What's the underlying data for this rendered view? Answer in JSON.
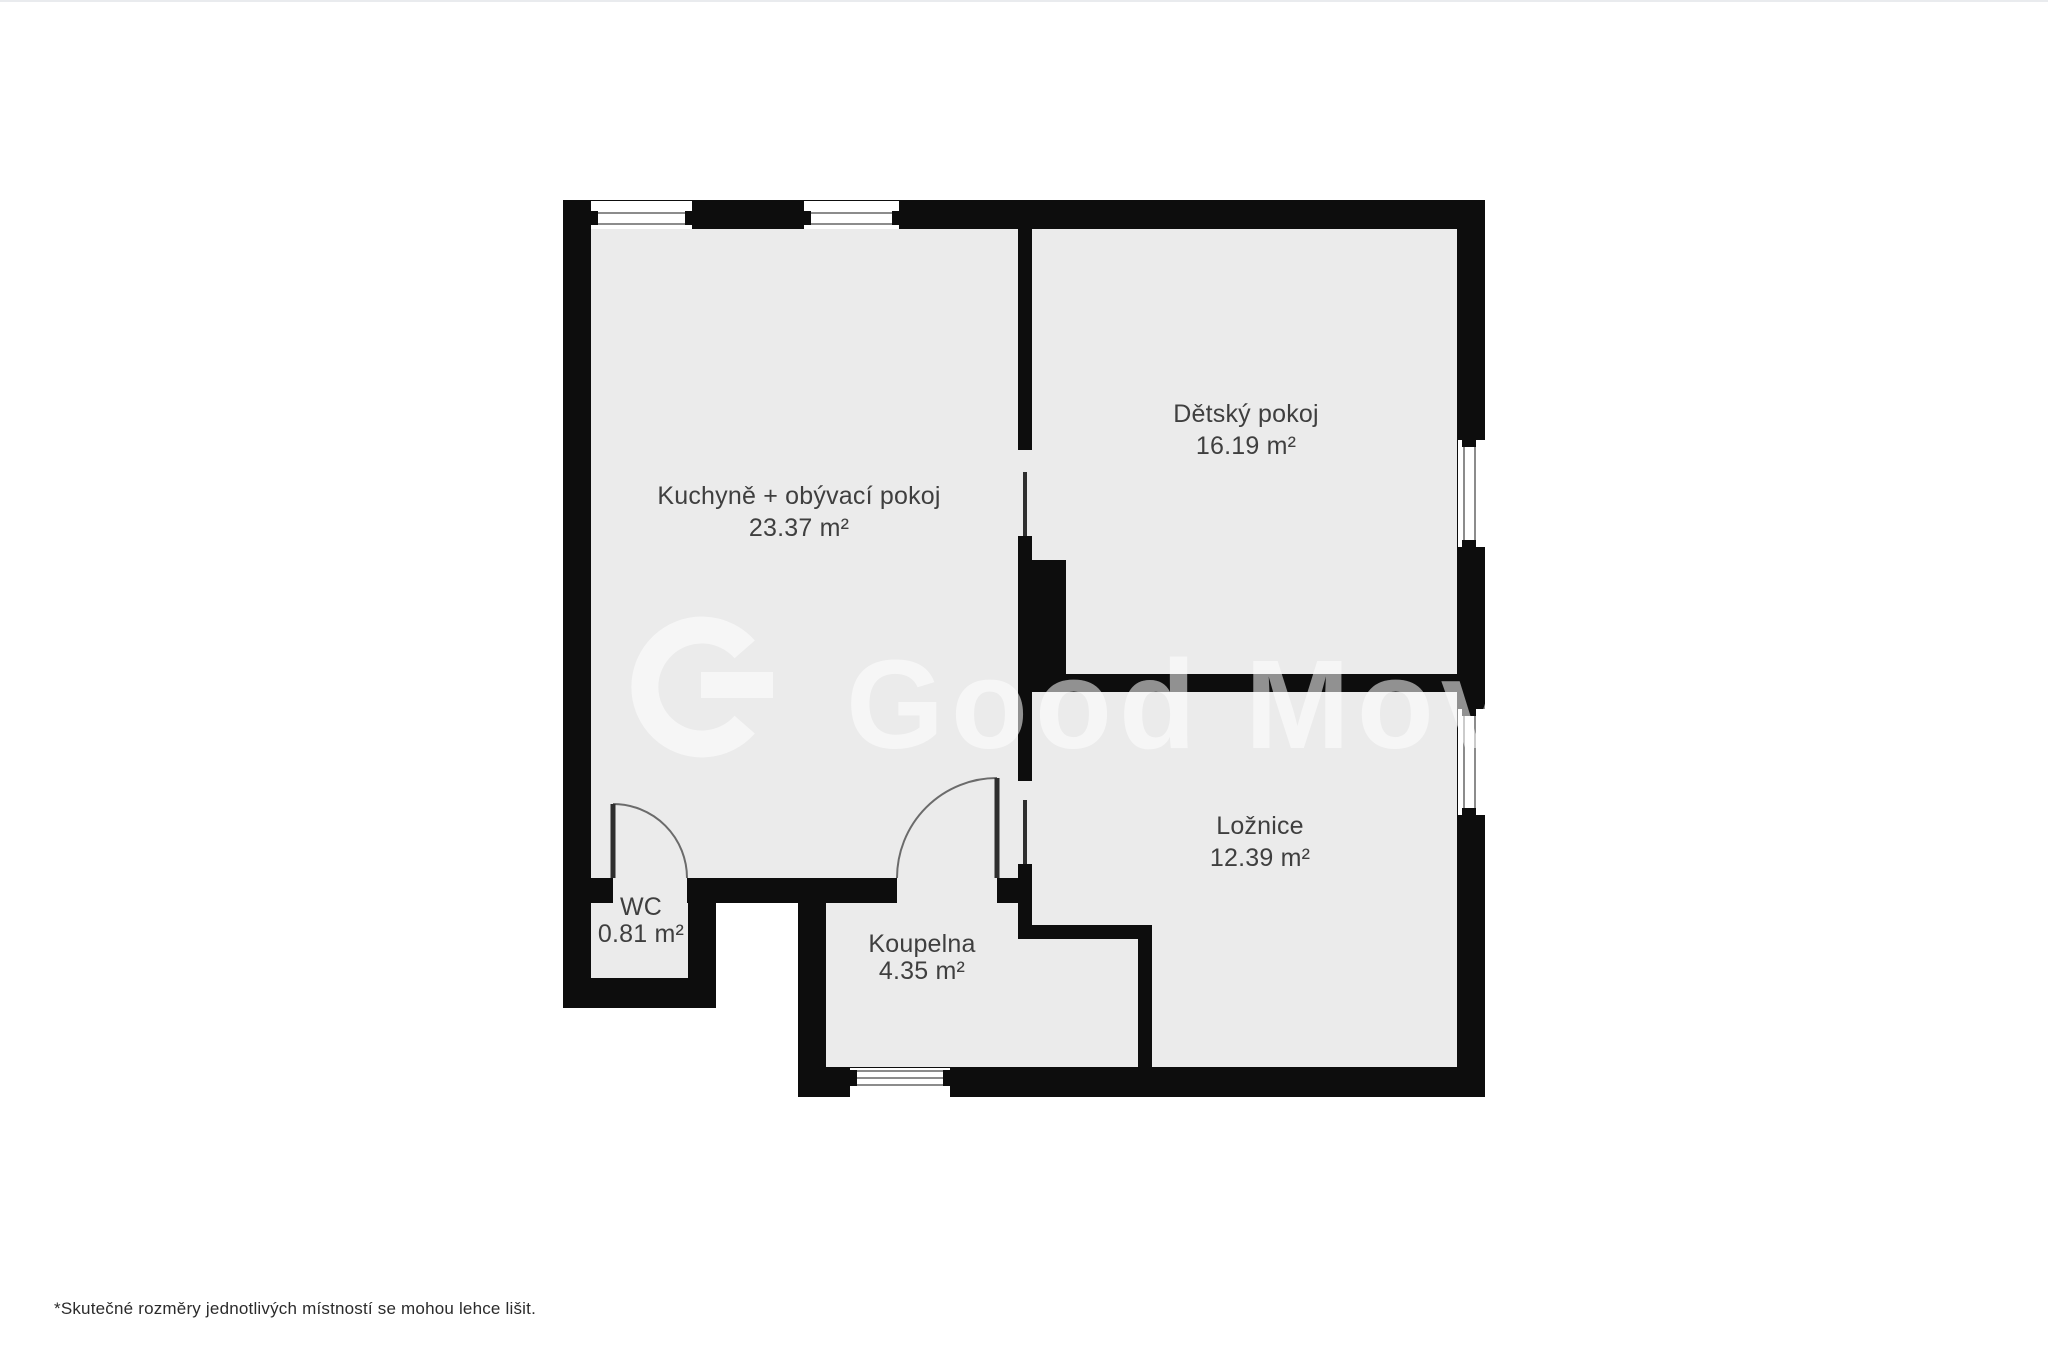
{
  "page": {
    "footnote": "*Skutečné rozměry jednotlivých místností se mohou lehce lišit."
  },
  "palette": {
    "wall": "#0d0d0d",
    "floor": "#ebebeb",
    "window_line": "#8c8c8c",
    "label_text": "#3f3f3f",
    "door_line": "#6b6b6b",
    "background": "#ffffff"
  },
  "watermark": {
    "text": "Good Move",
    "logo": "goodmove-g-logo"
  },
  "rooms": {
    "kitchen": {
      "name": "Kuchyně + obývací pokoj",
      "area": "23.37 m²"
    },
    "kids": {
      "name": "Dětský pokoj",
      "area": "16.19 m²"
    },
    "bedroom": {
      "name": "Ložnice",
      "area": "12.39 m²"
    },
    "bathroom": {
      "name": "Koupelna",
      "area": "4.35 m²"
    },
    "wc": {
      "name": "WC",
      "area": "0.81 m²"
    }
  }
}
